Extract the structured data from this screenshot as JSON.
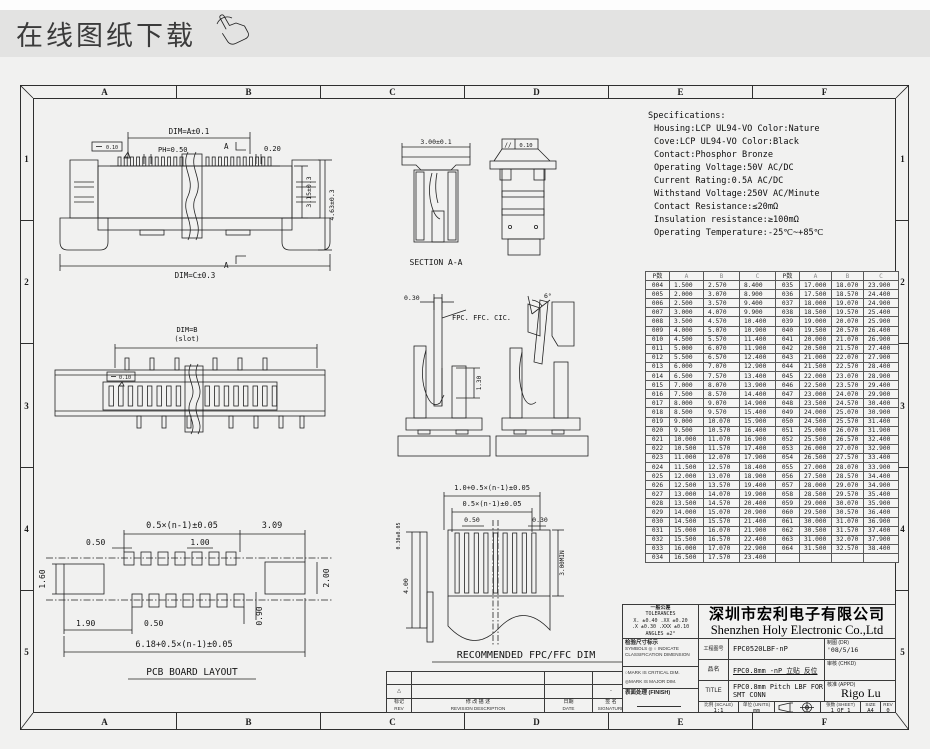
{
  "header": {
    "title": "在线图纸下载"
  },
  "sheet": {
    "zone_letters": [
      "A",
      "B",
      "C",
      "D",
      "E",
      "F"
    ],
    "zone_numbers": [
      "1",
      "2",
      "3",
      "4",
      "5"
    ]
  },
  "specifications": {
    "title": "Specifications:",
    "lines": [
      "Housing:LCP UL94-VO Color:Nature",
      "Cove:LCP UL94-VO Color:Black",
      "Contact:Phosphor Bronze",
      "Operating Voltage:50V AC/DC",
      "Current Rating:0.5A AC/DC",
      "Withstand Voltage:250V AC/Minute",
      "Contact Resistance:≤20mΩ",
      "Insulation resistance:≥100mΩ",
      "Operating Temperature:-25℃~+85℃"
    ]
  },
  "dim_table": {
    "headers": [
      "P数",
      "A",
      "B",
      "C",
      "P数",
      "A",
      "B",
      "C"
    ],
    "rows": [
      [
        "004",
        "1.500",
        "2.570",
        "8.400",
        "035",
        "17.000",
        "18.070",
        "23.900"
      ],
      [
        "005",
        "2.000",
        "3.070",
        "8.900",
        "036",
        "17.500",
        "18.570",
        "24.400"
      ],
      [
        "006",
        "2.500",
        "3.570",
        "9.400",
        "037",
        "18.000",
        "19.070",
        "24.900"
      ],
      [
        "007",
        "3.000",
        "4.070",
        "9.900",
        "038",
        "18.500",
        "19.570",
        "25.400"
      ],
      [
        "008",
        "3.500",
        "4.570",
        "10.400",
        "039",
        "19.000",
        "20.070",
        "25.900"
      ],
      [
        "009",
        "4.000",
        "5.070",
        "10.900",
        "040",
        "19.500",
        "20.570",
        "26.400"
      ],
      [
        "010",
        "4.500",
        "5.570",
        "11.400",
        "041",
        "20.000",
        "21.070",
        "26.900"
      ],
      [
        "011",
        "5.000",
        "6.070",
        "11.900",
        "042",
        "20.500",
        "21.570",
        "27.400"
      ],
      [
        "012",
        "5.500",
        "6.570",
        "12.400",
        "043",
        "21.000",
        "22.070",
        "27.900"
      ],
      [
        "013",
        "6.000",
        "7.070",
        "12.900",
        "044",
        "21.500",
        "22.570",
        "28.400"
      ],
      [
        "014",
        "6.500",
        "7.570",
        "13.400",
        "045",
        "22.000",
        "23.070",
        "28.900"
      ],
      [
        "015",
        "7.000",
        "8.070",
        "13.900",
        "046",
        "22.500",
        "23.570",
        "29.400"
      ],
      [
        "016",
        "7.500",
        "8.570",
        "14.400",
        "047",
        "23.000",
        "24.070",
        "29.900"
      ],
      [
        "017",
        "8.000",
        "9.070",
        "14.900",
        "048",
        "23.500",
        "24.570",
        "30.400"
      ],
      [
        "018",
        "8.500",
        "9.570",
        "15.400",
        "049",
        "24.000",
        "25.070",
        "30.900"
      ],
      [
        "019",
        "9.000",
        "10.070",
        "15.900",
        "050",
        "24.500",
        "25.570",
        "31.400"
      ],
      [
        "020",
        "9.500",
        "10.570",
        "16.400",
        "051",
        "25.000",
        "26.070",
        "31.900"
      ],
      [
        "021",
        "10.000",
        "11.070",
        "16.900",
        "052",
        "25.500",
        "26.570",
        "32.400"
      ],
      [
        "022",
        "10.500",
        "11.570",
        "17.400",
        "053",
        "26.000",
        "27.070",
        "32.900"
      ],
      [
        "023",
        "11.000",
        "12.070",
        "17.900",
        "054",
        "26.500",
        "27.570",
        "33.400"
      ],
      [
        "024",
        "11.500",
        "12.570",
        "18.400",
        "055",
        "27.000",
        "28.070",
        "33.900"
      ],
      [
        "025",
        "12.000",
        "13.070",
        "18.900",
        "056",
        "27.500",
        "28.570",
        "34.400"
      ],
      [
        "026",
        "12.500",
        "13.570",
        "19.400",
        "057",
        "28.000",
        "29.070",
        "34.900"
      ],
      [
        "027",
        "13.000",
        "14.070",
        "19.900",
        "058",
        "28.500",
        "29.570",
        "35.400"
      ],
      [
        "028",
        "13.500",
        "14.570",
        "20.400",
        "059",
        "29.000",
        "30.070",
        "35.900"
      ],
      [
        "029",
        "14.000",
        "15.070",
        "20.900",
        "060",
        "29.500",
        "30.570",
        "36.400"
      ],
      [
        "030",
        "14.500",
        "15.570",
        "21.400",
        "061",
        "30.000",
        "31.070",
        "36.900"
      ],
      [
        "031",
        "15.000",
        "16.070",
        "21.900",
        "062",
        "30.500",
        "31.570",
        "37.400"
      ],
      [
        "032",
        "15.500",
        "16.570",
        "22.400",
        "063",
        "31.000",
        "32.070",
        "37.900"
      ],
      [
        "033",
        "16.000",
        "17.070",
        "22.900",
        "064",
        "31.500",
        "32.570",
        "38.400"
      ],
      [
        "034",
        "16.500",
        "17.570",
        "23.400",
        "",
        "",
        "",
        ""
      ]
    ]
  },
  "views": {
    "front_view": {
      "dim_a": "DIM=A±0.1",
      "pitch": "PH=0.50",
      "d020": "0.20",
      "flatness": "0.10",
      "a_mark": "A",
      "h1": "3.15±0.3",
      "h2": "4.63±0.3",
      "dim_c": "DIM=C±0.3"
    },
    "section_aa": {
      "width": "3.00±0.1",
      "label": "SECTION A-A"
    },
    "side_view": {
      "parallel_sym": "//",
      "parallel_val": "0.10"
    },
    "top_view": {
      "dim_b": "DIM=B",
      "slot": "(slot)",
      "flatness": "0.10"
    },
    "contact_detail": {
      "d030": "0.30",
      "fpc_label": "FPC. FFC. CIC.",
      "d130": "1.30",
      "angle": "6°"
    },
    "pcb_layout": {
      "pitch_span": "0.5×(n-1)±0.05",
      "d309": "3.09",
      "d050a": "0.50",
      "d100": "1.00",
      "d160": "1.60",
      "d200": "2.00",
      "d190": "1.90",
      "d050b": "0.50",
      "d090": "0.90",
      "total": "6.18+0.5×(n-1)±0.05",
      "label": "PCB BOARD LAYOUT"
    },
    "fpc_dim": {
      "total": "1.0+0.5×(n-1)±0.05",
      "pitch_span": "0.5×(n-1)±0.05",
      "d050": "0.50",
      "d030": "0.30",
      "d030b": "0.30±0.05",
      "d400": "4.00",
      "d300": "3.00MIN",
      "label": "RECOMMENDED FPC/FFC DIM"
    }
  },
  "title_block": {
    "tol_title_cn": "一般公差",
    "tol_title_en": "TOLERANCES",
    "tol_line1": "X. ±0.40  .XX ±0.20",
    "tol_line2": ".X ±0.30  .XXX ±0.10",
    "tol_line3": "ANGLES    ±2°",
    "company_cn": "深圳市宏利电子有限公司",
    "company_en": "Shenzhen Holy Electronic Co.,Ltd",
    "insp_title": "检验尺寸标示",
    "insp_line1": "SYMBOLS ◎ ○ INDICATE",
    "insp_line2": "CLASSIFICATION DIMENSION",
    "mark1": "○MARK IS CRITICAL DIM.",
    "mark2": "◎MARK IS MAJOR DIM.",
    "finish_label": "表面处理 (FINISH)",
    "drawing_no_label": "工程图号",
    "drawing_no": "FPC0520LBF-nP",
    "dr_label": "制图 (DR)",
    "dr_value": "'08/5/16",
    "part_label": "品名",
    "part_name": "FPC0.8mm -nP 立贴 反位",
    "chk_label": "审核 (CHKD)",
    "title_label": "TITLE",
    "title_value": "FPC0.8mm Pitch LBF FOR SMT CONN",
    "appd_label": "核准 (APPD)",
    "appd_value": "Rigo Lu",
    "scale_label": "比例 (SCALE)",
    "scale_value": "1:1",
    "units_label": "单位 (UNITS)",
    "units_value": "mm",
    "sheet_label": "张数 (SHEET)",
    "sheet_value": "1 OF 1",
    "size_label": "SIZE",
    "size_value": "A4",
    "rev_label": "REV",
    "rev_value": "0"
  },
  "revision_strip": {
    "mark": "△",
    "sign_dash": "-",
    "rev_cn": "标记",
    "rev_en": "REV",
    "desc_cn": "修 改 描 述",
    "desc_en": "REVISION DESCRIPTION",
    "date_cn": "日期",
    "date_en": "DATE",
    "sign_cn": "签 名",
    "sign_en": "SIGNATURE"
  },
  "colors": {
    "header_bg": "#e3e3e2",
    "page_bg": "#f1f1f0",
    "line": "#2f2f2f",
    "table_line": "#5a5a5a"
  }
}
